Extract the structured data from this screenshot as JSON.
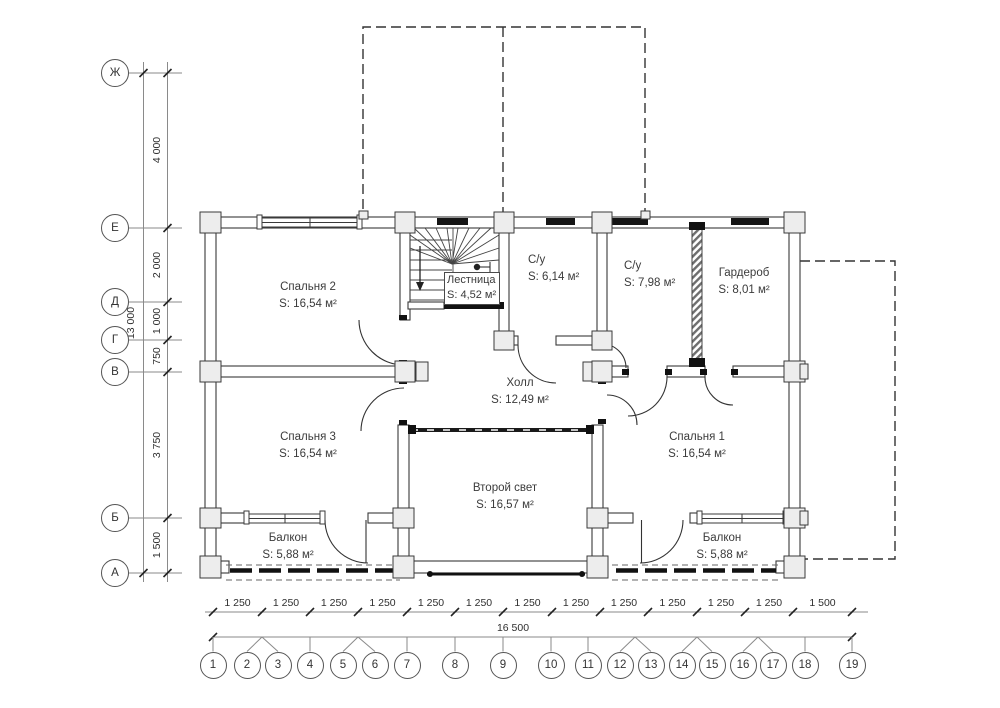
{
  "plan": {
    "rooms": [
      {
        "name": "Спальня 2",
        "area": "S: 16,54 м²"
      },
      {
        "name": "Лестница",
        "area": "S: 4,52 м²"
      },
      {
        "name": "С/у",
        "area": "S: 6,14 м²"
      },
      {
        "name": "С/у",
        "area": "S: 7,98 м²"
      },
      {
        "name": "Гардероб",
        "area": "S: 8,01 м²"
      },
      {
        "name": "Холл",
        "area": "S: 12,49 м²"
      },
      {
        "name": "Спальня 3",
        "area": "S: 16,54 м²"
      },
      {
        "name": "Спальня 1",
        "area": "S: 16,54 м²"
      },
      {
        "name": "Второй свет",
        "area": "S: 16,57 м²"
      },
      {
        "name": "Балкон",
        "area": "S: 5,88 м²"
      },
      {
        "name": "Балкон",
        "area": "S: 5,88 м²"
      }
    ],
    "row_axes": [
      "Ж",
      "Е",
      "Д",
      "Г",
      "В",
      "Б",
      "А"
    ],
    "col_axes": [
      "1",
      "2",
      "3",
      "4",
      "5",
      "6",
      "7",
      "8",
      "9",
      "10",
      "11",
      "12",
      "13",
      "14",
      "15",
      "16",
      "17",
      "18",
      "19"
    ],
    "dims": {
      "left_segments": [
        "4 000",
        "2 000",
        "1 000",
        "750",
        "3 750",
        "1 500"
      ],
      "left_total": "13 000",
      "bottom_segments": [
        "1 250",
        "1 250",
        "1 250",
        "1 250",
        "1 250",
        "1 250",
        "1 250",
        "1 250",
        "1 250",
        "1 250",
        "1 250",
        "1 250",
        "1 500"
      ],
      "bottom_total": "16 500"
    },
    "colors": {
      "line": "#3a3a3a",
      "text": "#3b3b3b",
      "wall_fill": "#ffffff",
      "joint_fill": "#ededed",
      "background": "#ffffff"
    }
  }
}
